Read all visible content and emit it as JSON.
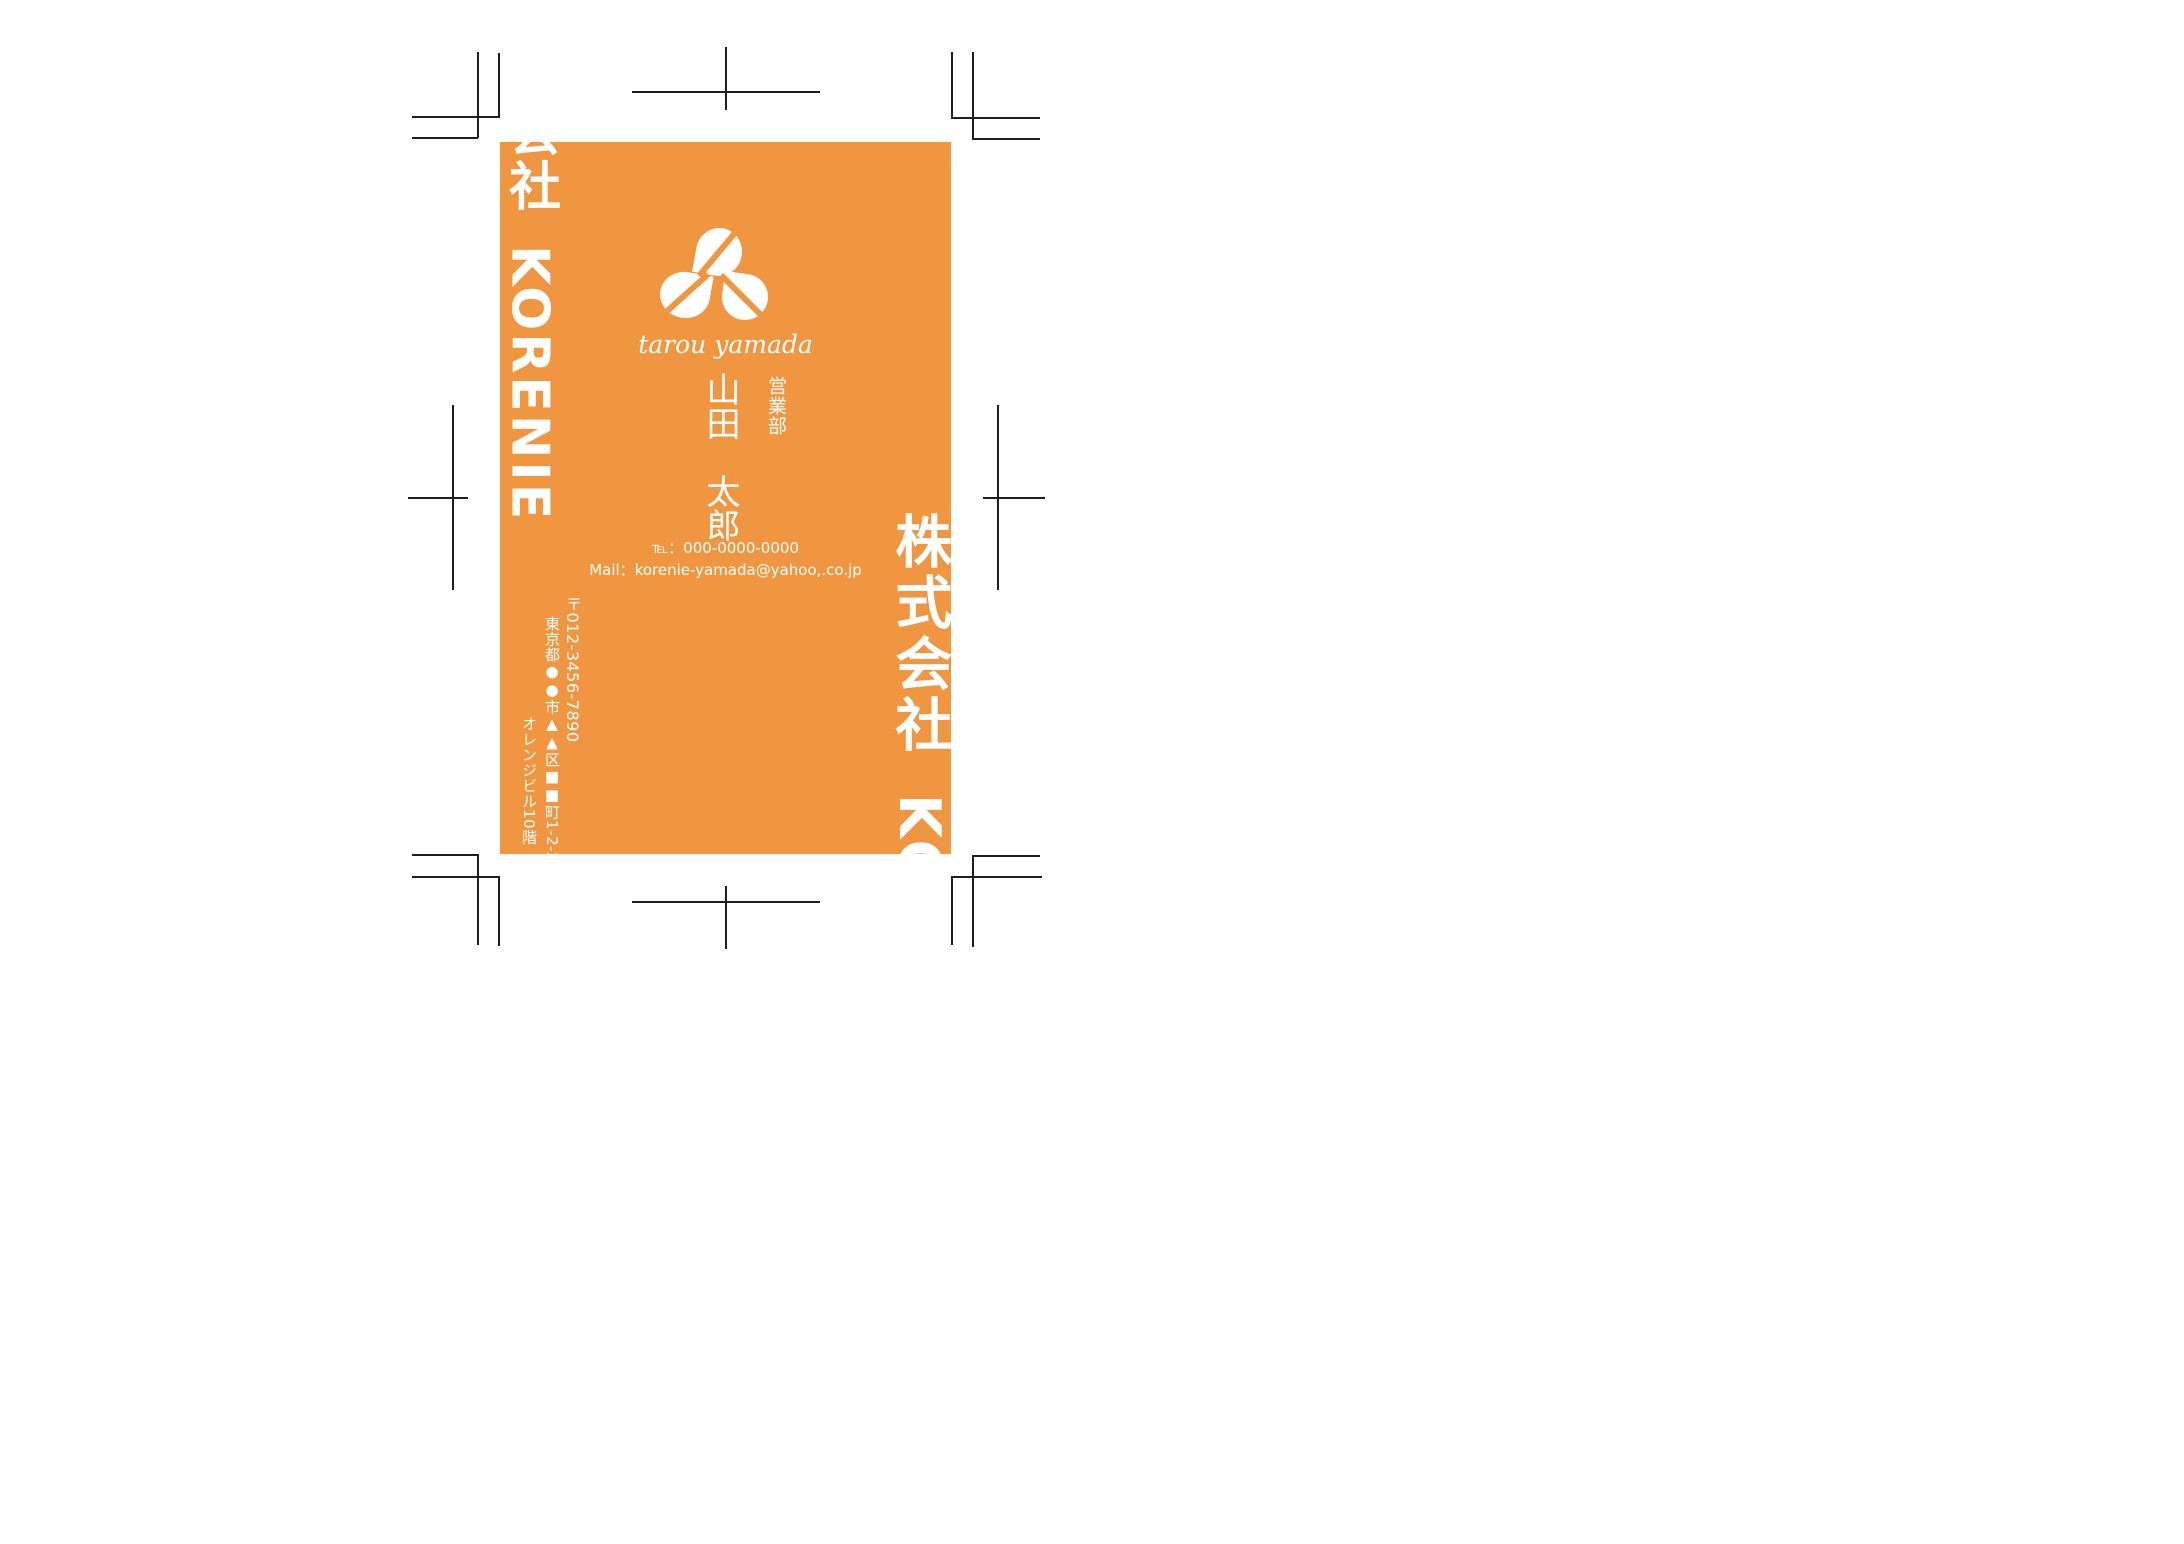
{
  "card": {
    "background_color": "#F09641",
    "text_color": "#FFFFFF",
    "mark_color": "#1E1E1E",
    "edge_text_left": "会社 KORENIE",
    "edge_text_right": "株式会社 KO",
    "logo_name": "three-leaves-logo",
    "name_roman": "tarou yamada",
    "name_vertical": "山田　太郎",
    "department": "営業部",
    "tel_label": "℡：",
    "tel_value": "000-0000-0000",
    "mail_label": "Mail：",
    "mail_value": "korenie-yamada@yahoo,.co.jp",
    "address_postal": "〒012-3456-7890",
    "address_line1": "東京都●●市▲▲区■■町1-2-3",
    "address_line2": "オレンジビル10階"
  }
}
